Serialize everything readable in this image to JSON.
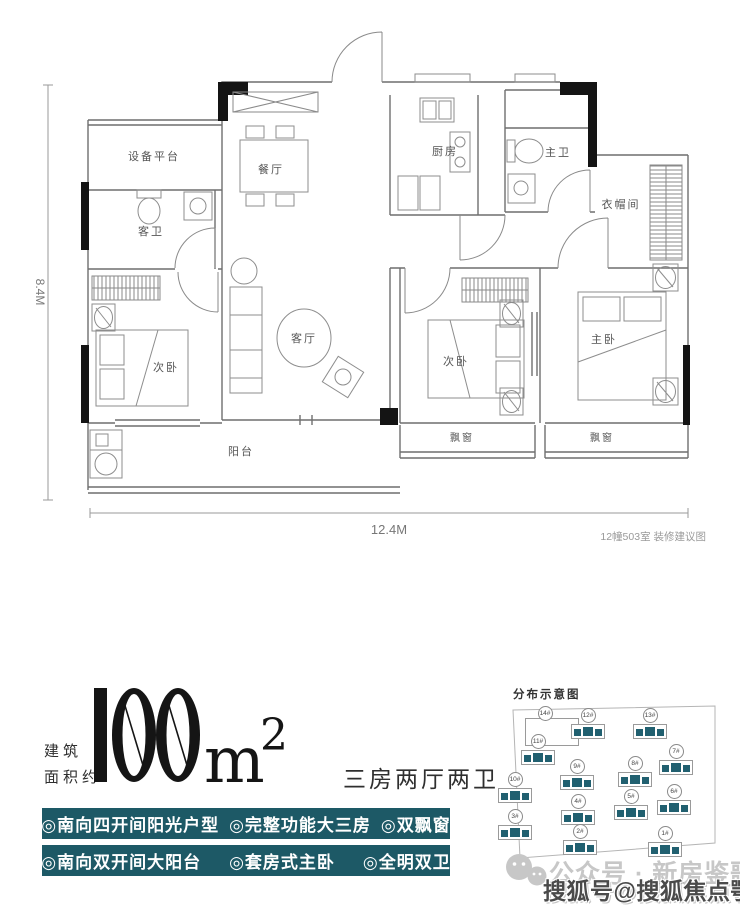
{
  "plan": {
    "rooms": {
      "equipment": "设备平台",
      "dining": "餐厅",
      "guest_bath": "客卫",
      "kitchen": "厨房",
      "master_bath": "主卫",
      "cloak": "衣帽间",
      "living": "客厅",
      "bedroom2_left": "次卧",
      "bedroom2_right": "次卧",
      "master_bedroom": "主卧",
      "balcony": "阳台",
      "bay_window_left": "飘窗",
      "bay_window_right": "飘窗"
    },
    "dim_height": "8.4M",
    "dim_width": "12.4M",
    "caption": "12幢503室 装修建议图"
  },
  "area": {
    "prefix_line1": "建筑",
    "prefix_line2": "面积约",
    "value": "100",
    "unit": "m",
    "sup": "2",
    "layout": "三房两厅两卫"
  },
  "features": {
    "row1": [
      "◎南向四开间阳光户型",
      "◎完整功能大三房",
      "◎双飘窗"
    ],
    "row2": [
      "◎南向双开间大阳台",
      "◎套房式主卧",
      "◎全明双卫"
    ]
  },
  "distribution": {
    "title": "分布示意图",
    "buildings": [
      {
        "label": "14#",
        "x": 30,
        "y": 22,
        "empty": true
      },
      {
        "label": "12#",
        "x": 73,
        "y": 24
      },
      {
        "label": "13#",
        "x": 135,
        "y": 24
      },
      {
        "label": "11#",
        "x": 23,
        "y": 50
      },
      {
        "label": "7#",
        "x": 161,
        "y": 60
      },
      {
        "label": "9#",
        "x": 62,
        "y": 75
      },
      {
        "label": "8#",
        "x": 120,
        "y": 72
      },
      {
        "label": "10#",
        "x": 0,
        "y": 88
      },
      {
        "label": "6#",
        "x": 159,
        "y": 100
      },
      {
        "label": "4#",
        "x": 63,
        "y": 110
      },
      {
        "label": "5#",
        "x": 116,
        "y": 105
      },
      {
        "label": "3#",
        "x": 0,
        "y": 125
      },
      {
        "label": "2#",
        "x": 65,
        "y": 140
      },
      {
        "label": "1#",
        "x": 150,
        "y": 142
      }
    ]
  },
  "watermark": {
    "wechat": "公众号 · 新房鉴歌",
    "sohu": "搜狐号@搜狐焦点鄂州站"
  },
  "colors": {
    "banner_teal": "#1d5966",
    "building_teal": "#216070",
    "ink": "#151515"
  }
}
